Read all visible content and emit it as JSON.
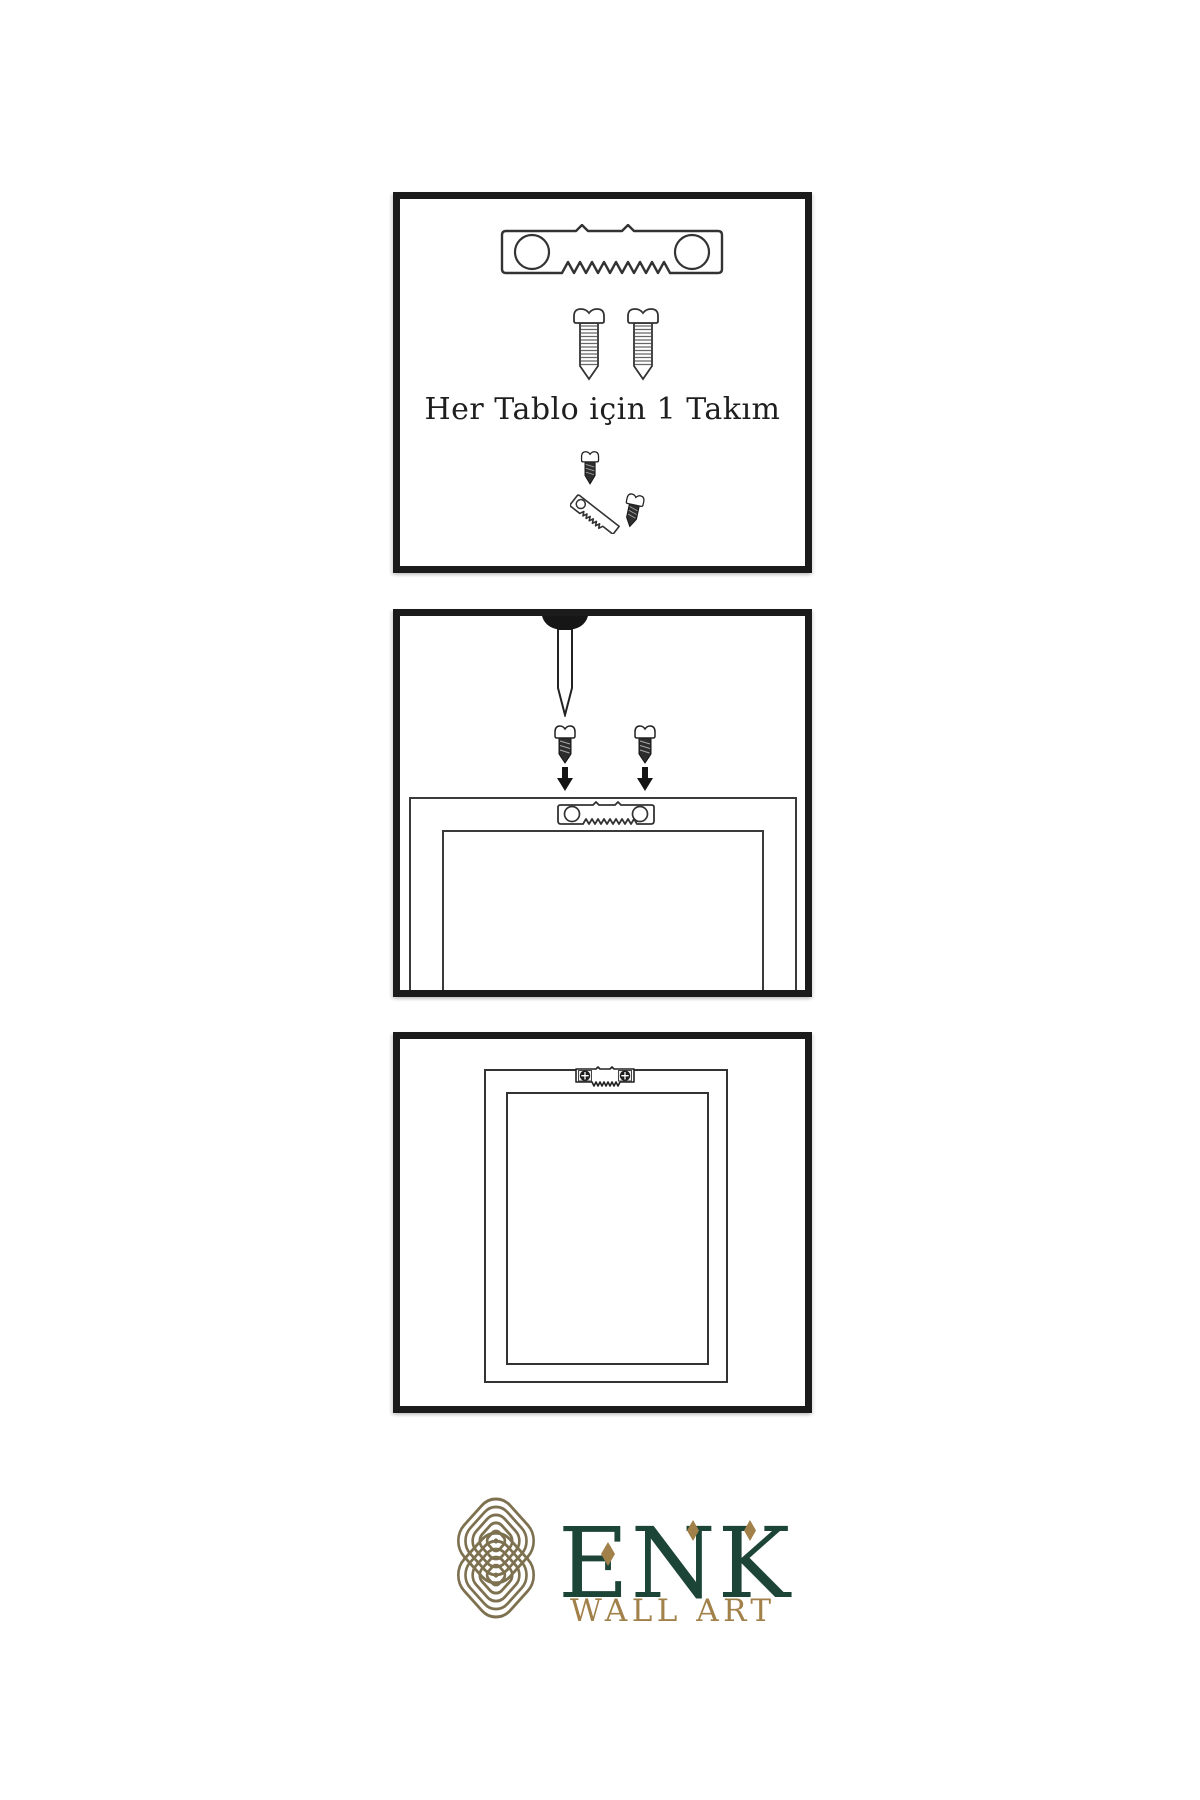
{
  "background": "#ffffff",
  "colors": {
    "panel_border": "#1b1b1b",
    "illustration_line": "#333333",
    "dark_hardware_fill": "#2d2d2d",
    "brand_green": "#1c4537",
    "brand_gold": "#a18049",
    "knot_gold": "#7d7150"
  },
  "steps": [
    {
      "name": "hardware-kit",
      "caption": "Her Tablo için 1 Takım",
      "items": [
        "sawtooth-hanger",
        "screw",
        "screw",
        "screw-into-hanger-kit"
      ]
    },
    {
      "name": "attach-hanger-to-frame",
      "items": [
        "wall-nail",
        "screw-down",
        "screw-down",
        "arrow-down",
        "arrow-down",
        "frame-back",
        "sawtooth-hanger"
      ]
    },
    {
      "name": "frame-hung-on-wall",
      "items": [
        "frame-back",
        "sawtooth-hanger-installed"
      ]
    }
  ],
  "brand": {
    "name": "ENK",
    "subtitle": "WALL ART"
  }
}
